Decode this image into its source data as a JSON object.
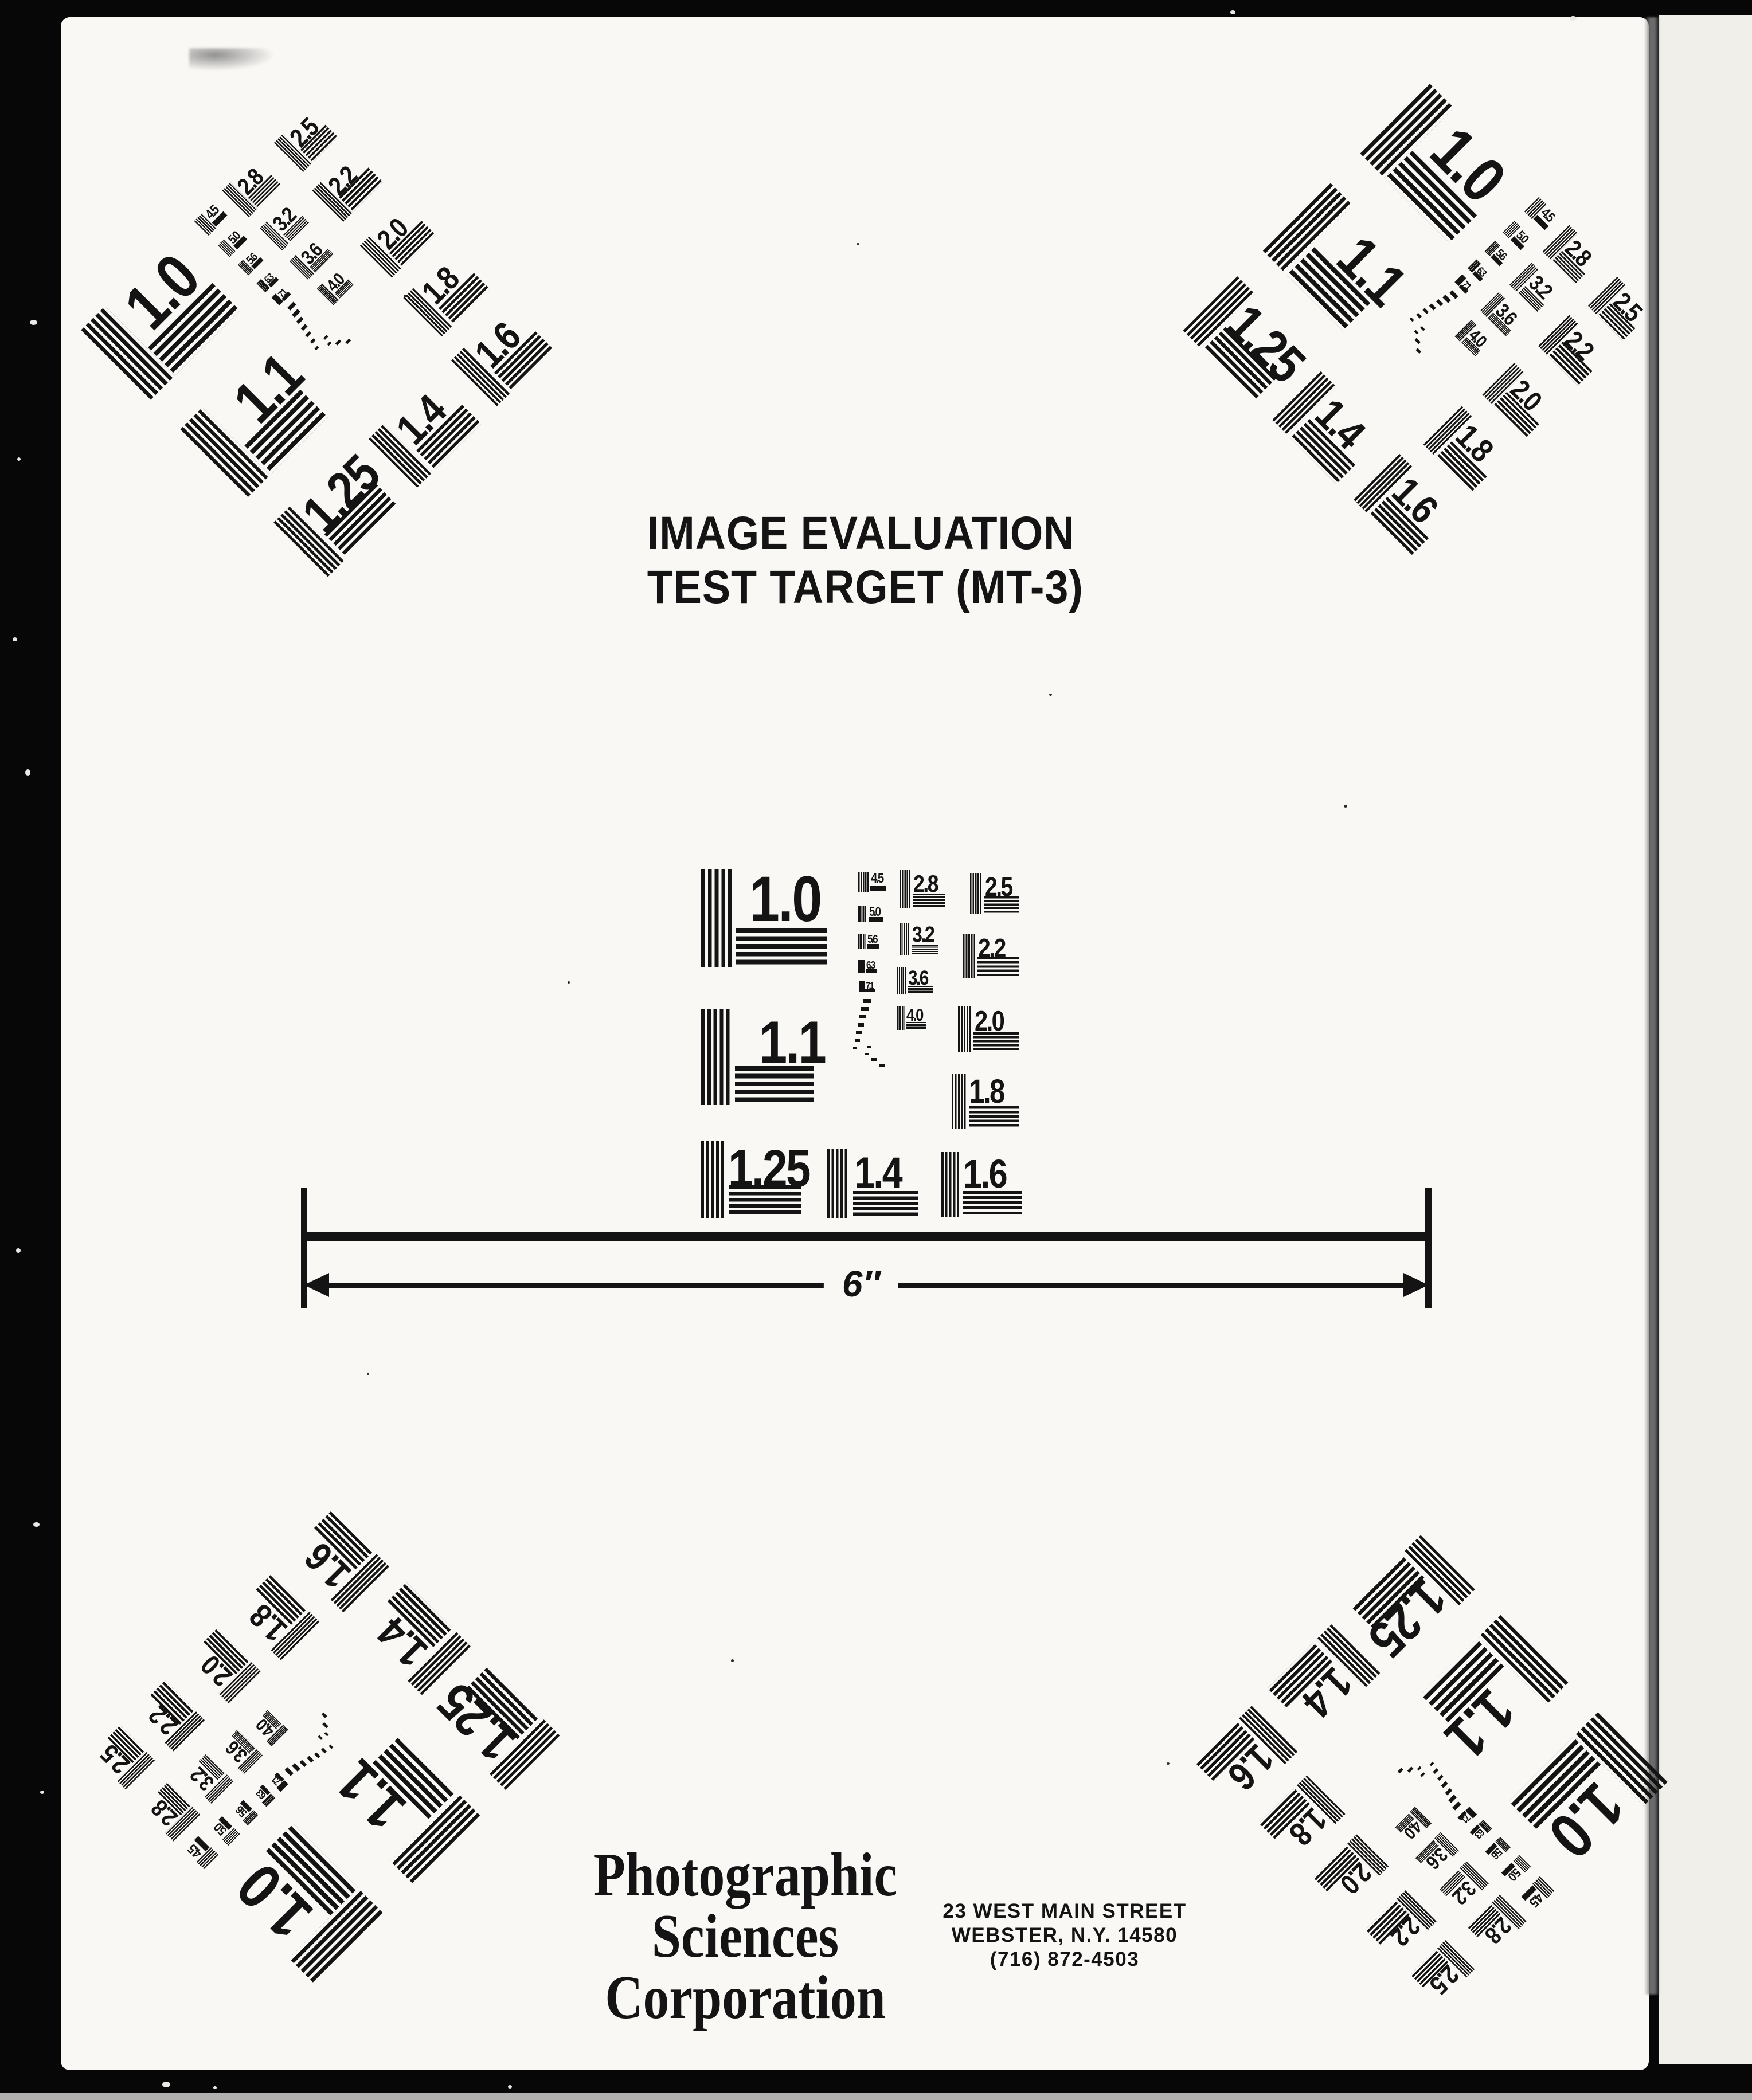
{
  "title": {
    "lines": [
      "IMAGE EVALUATION",
      "TEST TARGET (MT-3)"
    ]
  },
  "ruler": {
    "label": "6″"
  },
  "publisher": {
    "name_lines": [
      "Photographic",
      "Sciences",
      "Corporation"
    ],
    "address_lines": [
      "23 WEST MAIN STREET",
      "WEBSTER, N.Y. 14580",
      "(716) 872-4503"
    ]
  },
  "target": {
    "group_labels": [
      "1.0",
      "1.1",
      "1.25",
      "1.4",
      "1.6",
      "2.5",
      "2.2",
      "2.0",
      "1.8",
      "2.8",
      "3.2",
      "3.6",
      "4.0",
      "4.5",
      "5.0",
      "5.6",
      "6.3",
      "7.1"
    ],
    "instances": [
      {
        "position": "top-left",
        "rotation_deg": -45
      },
      {
        "position": "top-right",
        "rotation_deg": 45
      },
      {
        "position": "center",
        "rotation_deg": 0
      },
      {
        "position": "bottom-left",
        "rotation_deg": -135
      },
      {
        "position": "bottom-right",
        "rotation_deg": 135
      }
    ]
  },
  "colors": {
    "background": "#070707",
    "paper": "#f9f8f5",
    "side_paper": "#f0efea",
    "ink": "#141414",
    "page_gap_gray": "#7d7d7d",
    "bottom_edge_light": "#cfcecb"
  }
}
